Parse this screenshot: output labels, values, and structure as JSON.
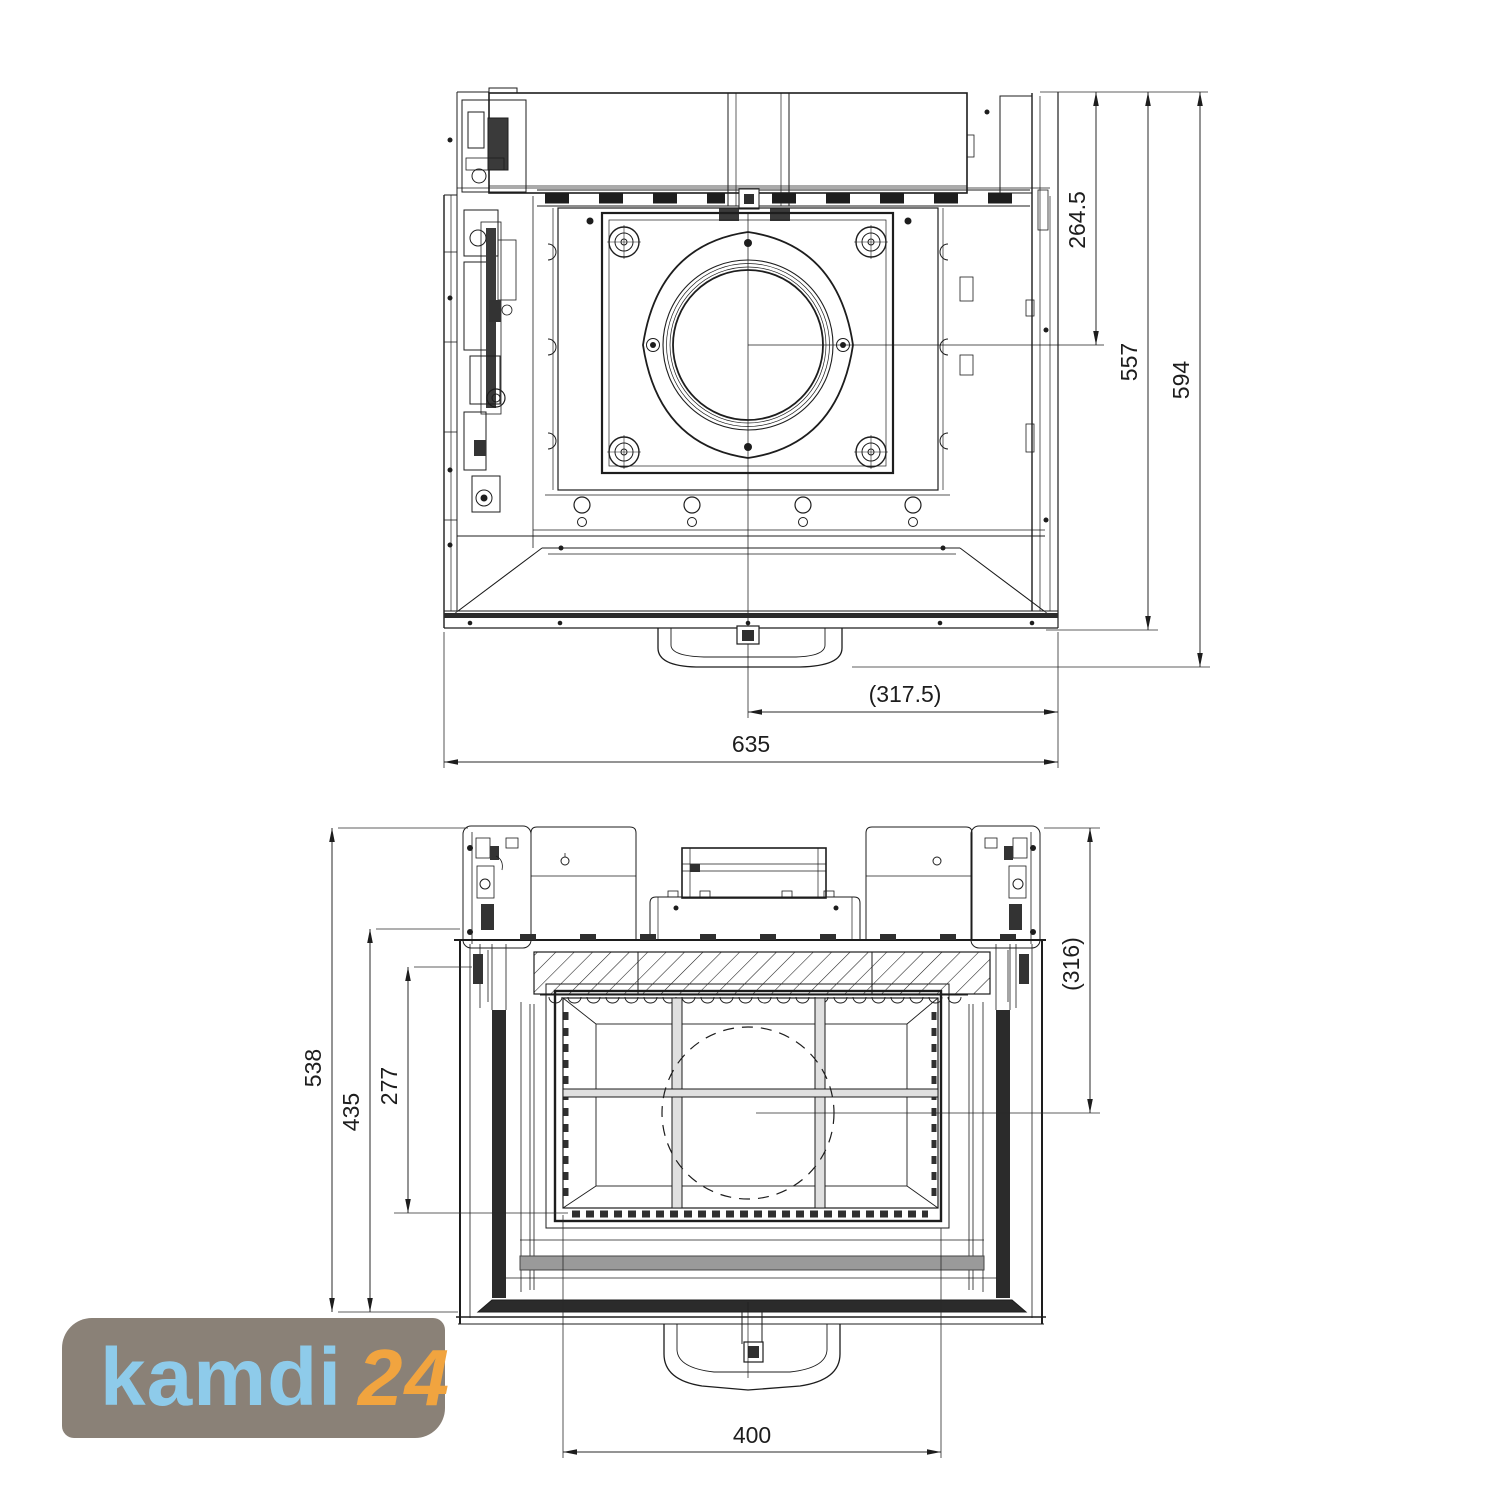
{
  "drawing": {
    "line_color": "#1d1d1d",
    "top_view": {
      "dims": {
        "rear_to_flue_center": "264.5",
        "body_depth": "557",
        "total_depth": "594",
        "center_to_side": "(317.5)",
        "total_width": "635"
      }
    },
    "front_view": {
      "dims": {
        "total_height": "538",
        "frame_height": "435",
        "glass_height": "277",
        "top_to_flue_center": "(316)",
        "glass_width": "400"
      }
    }
  },
  "logo": {
    "brand": "kamdi",
    "suffix": "24",
    "background_color": "#8a8177",
    "brand_color": "#8ecbea",
    "suffix_color": "#f1a43f"
  }
}
